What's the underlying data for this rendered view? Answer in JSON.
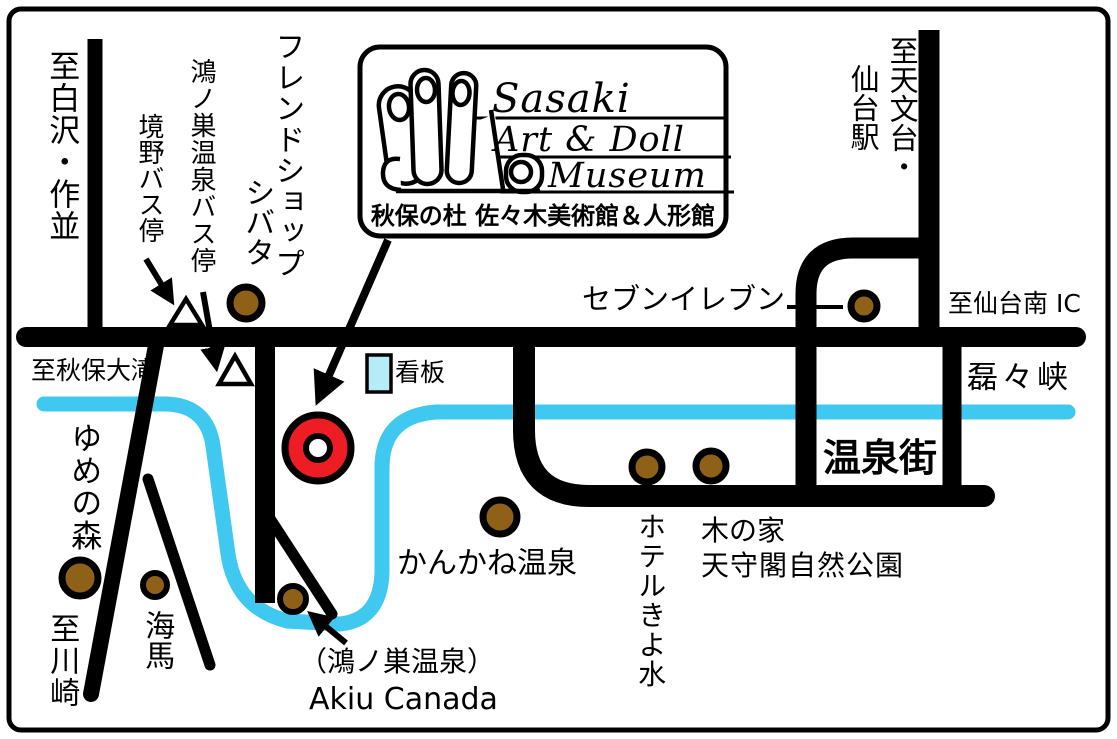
{
  "colors": {
    "road": "#000000",
    "river": "#3fc8f0",
    "sign_board": "#b6ecf7",
    "marker_brown": "#8f6118",
    "museum_red": "#ee1c23",
    "background": "#ffffff"
  },
  "logo": {
    "name_line1": "Sasaki",
    "name_line2": "Art & Doll",
    "name_line3": "Museum",
    "subtitle": "秋保の杜 佐々木美術館＆人形館"
  },
  "labels": {
    "to_shirasawa_sakunami": "至白沢・作並",
    "konosu_onsen_bus_stop": "鴻ノ巣温泉バス停",
    "sakaino_bus_stop": "境野バス停",
    "friend_shop": "フレンドショップ",
    "shibata": "シバタ",
    "to_observatory": "至天文台・",
    "sendai_station": "仙台駅",
    "seven_eleven": "セブンイレブン",
    "to_sendai_minami_ic": "至仙台南 IC",
    "to_akiu_otaki": "至秋保大滝",
    "signboard": "看板",
    "rairaikyo": "磊々峡",
    "onsen_town": "温泉街",
    "kankane_onsen": "かんかね温泉",
    "hotel_kiyomizu": "ホテルきよ水",
    "ki_no_ie": "木の家",
    "tenshukaku_park": "天守閣自然公園",
    "konosu_onsen_paren": "（鴻ノ巣温泉）",
    "akiu_canada": "Akiu Canada",
    "yume_no_mori": "ゆめの森",
    "kaiba": "海馬",
    "to_kawasaki": "至川崎"
  }
}
